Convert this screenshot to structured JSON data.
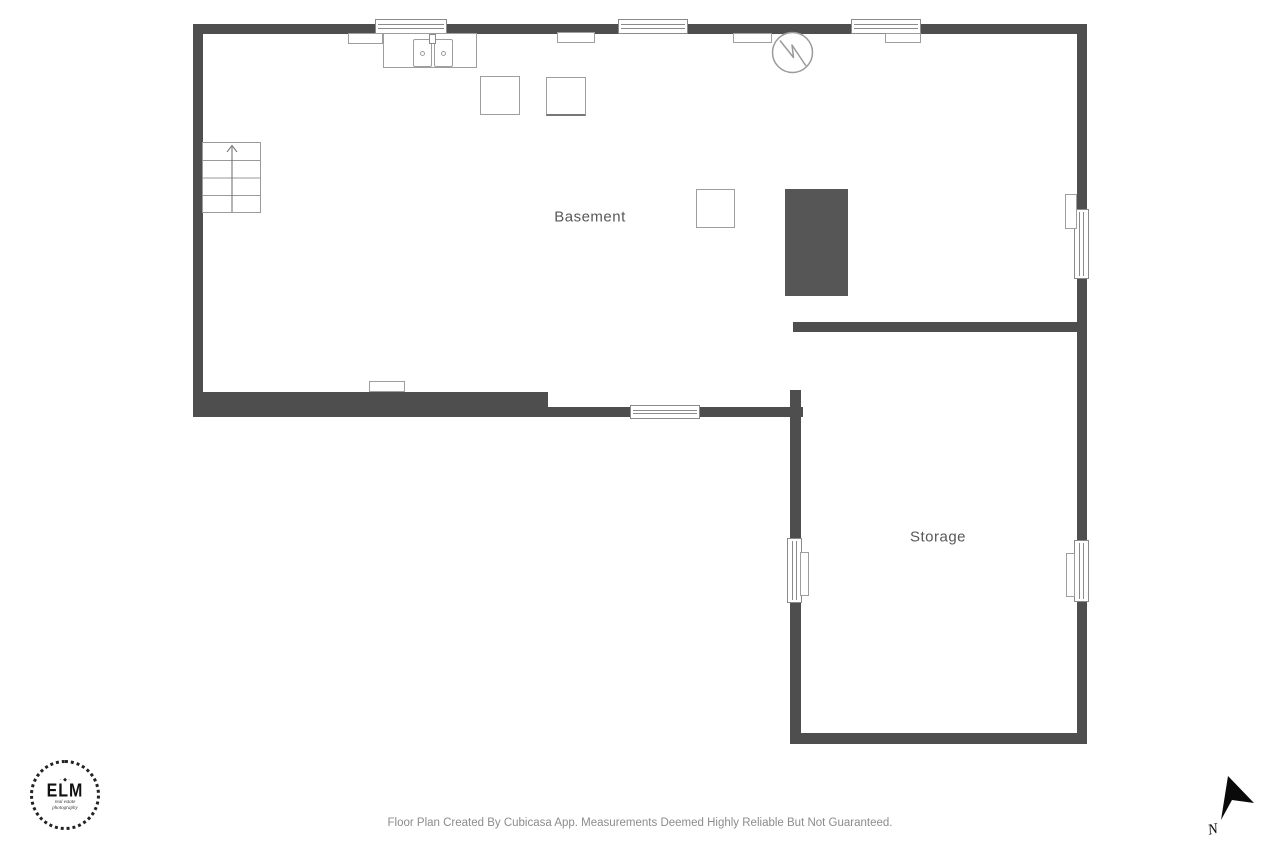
{
  "title": "Basement Floor Plan",
  "colors": {
    "wall": "#4e4e4e",
    "fixture_border": "#9e9e9e",
    "window_border": "#8a8a8a",
    "room_label": "#585858",
    "dark_block": "#565656",
    "footer_text": "#8c8c8c",
    "compass": "#0a0a0a"
  },
  "rooms": [
    {
      "label": "Basement"
    },
    {
      "label": "Storage"
    }
  ],
  "symbols": {
    "water_heater": "water-heater-circle-symbol",
    "stairs": "stairs-with-up-arrow",
    "compass": "north-arrow"
  },
  "logo": {
    "ornament": "· ◆ ·",
    "title": "ELM",
    "subtitle_line1": "real estate",
    "subtitle_line2": "photography"
  },
  "compass": {
    "label": "N"
  },
  "footer": {
    "disclaimer": "Floor Plan Created By Cubicasa App. Measurements Deemed Highly Reliable But Not Guaranteed."
  }
}
